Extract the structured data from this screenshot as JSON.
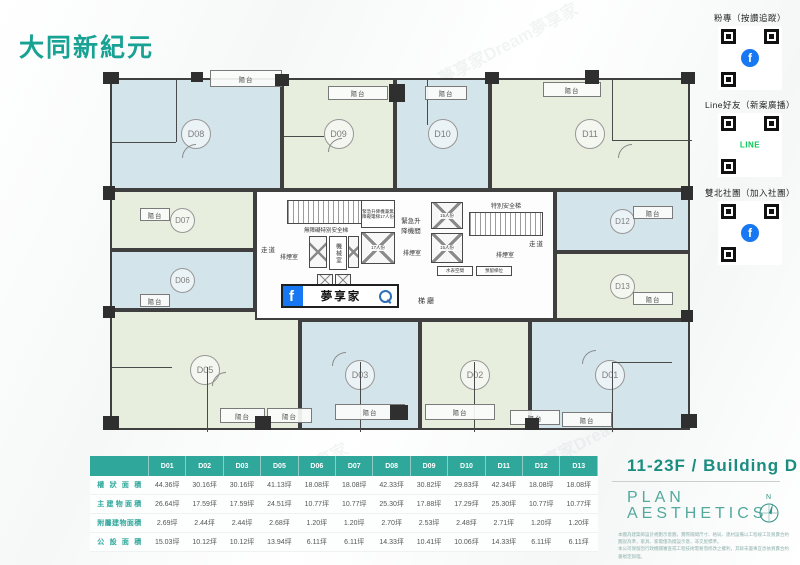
{
  "page": {
    "title": "大同新紀元",
    "watermark": "夢享家Dream夢享家"
  },
  "qr_panel": {
    "facebook_f": "f",
    "line_text": "LINE",
    "sections": [
      {
        "label": "粉專（按讚追蹤）",
        "logo": "facebook-qr"
      },
      {
        "label": "Line好友（新案廣播）",
        "logo": "line-qr"
      },
      {
        "label": "雙北社團（加入社團）",
        "logo": "facebook-qr"
      }
    ]
  },
  "plan": {
    "balcony_label": "陽台",
    "corridor_label": "走道",
    "units": [
      {
        "label": "D01"
      },
      {
        "label": "D02"
      },
      {
        "label": "D03"
      },
      {
        "label": "D05"
      },
      {
        "label": "D06"
      },
      {
        "label": "D07"
      },
      {
        "label": "D08"
      },
      {
        "label": "D09"
      },
      {
        "label": "D10"
      },
      {
        "label": "D11"
      },
      {
        "label": "D12"
      },
      {
        "label": "D13"
      }
    ],
    "core": {
      "barrier_free_stair": "無障礙特別安全梯",
      "smoke_room": "排煙室",
      "machine_room": "機械室",
      "emergency_elev_note": "緊急升降機兼無障礙電梯17人份",
      "elev_17": "17人份",
      "elev_15": "15人份",
      "emergency_elev_hall": "緊急升降機間",
      "special_stair": "特別安全梯",
      "lobby": "梯廳",
      "water_meter": "水表空間",
      "reserved_shaft": "預留梯位"
    },
    "fb_banner": {
      "search_text": "夢享家"
    }
  },
  "table": {
    "columns": [
      "D01",
      "D02",
      "D03",
      "D05",
      "D06",
      "D07",
      "D08",
      "D09",
      "D10",
      "D11",
      "D12",
      "D13"
    ],
    "rows": [
      {
        "label": "權狀面積",
        "values": [
          "44.36坪",
          "30.16坪",
          "30.16坪",
          "41.13坪",
          "18.08坪",
          "18.08坪",
          "42.33坪",
          "30.82坪",
          "29.83坪",
          "42.34坪",
          "18.08坪",
          "18.08坪"
        ]
      },
      {
        "label": "主建物面積",
        "values": [
          "26.64坪",
          "17.59坪",
          "17.59坪",
          "24.51坪",
          "10.77坪",
          "10.77坪",
          "25.30坪",
          "17.88坪",
          "17.29坪",
          "25.30坪",
          "10.77坪",
          "10.77坪"
        ]
      },
      {
        "label": "附屬建物面積",
        "values": [
          "2.69坪",
          "2.44坪",
          "2.44坪",
          "2.68坪",
          "1.20坪",
          "1.20坪",
          "2.70坪",
          "2.53坪",
          "2.48坪",
          "2.71坪",
          "1.20坪",
          "1.20坪"
        ]
      },
      {
        "label": "公設面積",
        "values": [
          "15.03坪",
          "10.12坪",
          "10.12坪",
          "13.94坪",
          "6.11坪",
          "6.11坪",
          "14.33坪",
          "10.41坪",
          "10.06坪",
          "14.33坪",
          "6.11坪",
          "6.11坪"
        ]
      }
    ]
  },
  "footer": {
    "floor_title": "11-23F / Building D",
    "plan_word": "PLAN",
    "aesthetics_word": "AESTHETICS",
    "compass_n": "N",
    "disclaimer_line1": "本圖為建築師設計規劃示意圖，實際隔間尺寸、格局、建材設備以工程竣工及買賣合約圖說為準，家具、家電僅為擺設示意，非交屋標準。",
    "disclaimer_line2": "本公司保留因行政機關審查或工程技術需要而修改之權利，其餘未盡事宜悉依買賣合約書規定辦理。"
  }
}
